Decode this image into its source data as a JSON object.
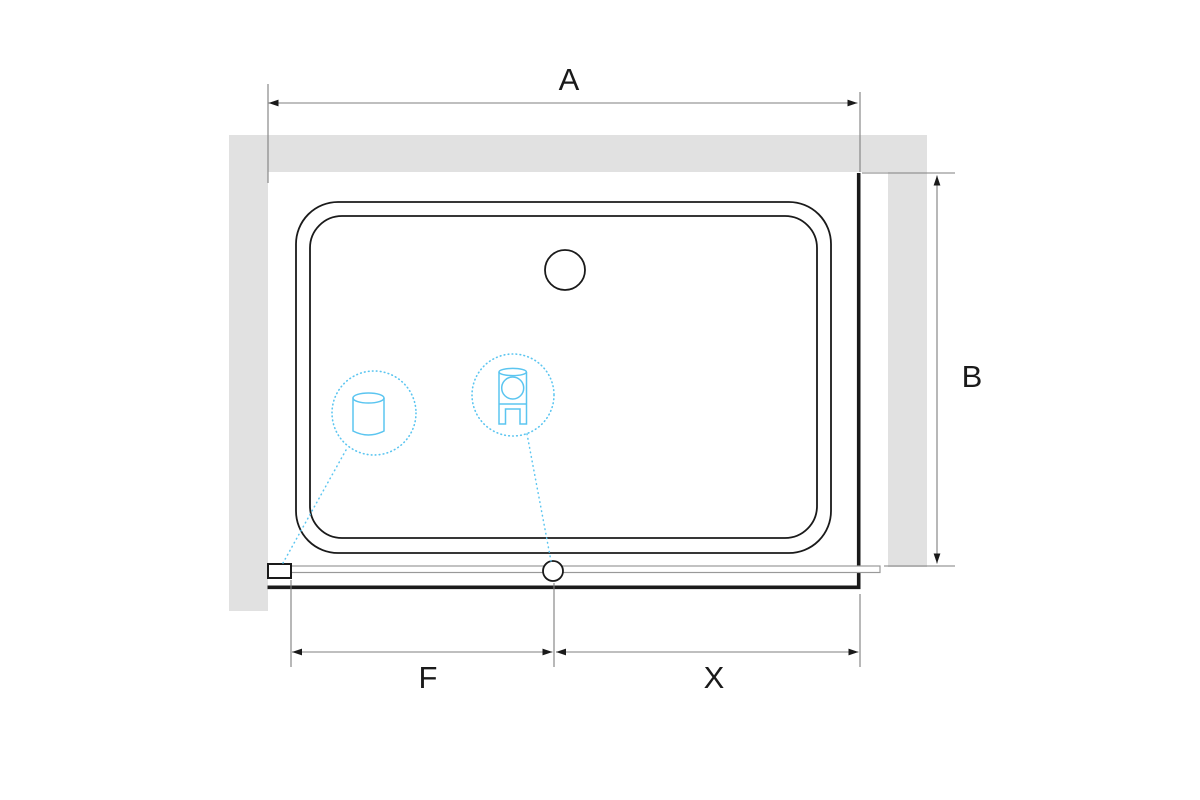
{
  "diagram": {
    "kind": "shower-enclosure-top-view-dimension-drawing",
    "dimension_labels": {
      "top": "A",
      "right": "B",
      "bottom_left": "F",
      "bottom_right": "X"
    },
    "colors": {
      "background": "#ffffff",
      "wall_fill": "#e1e1e1",
      "outline": "#1a1a1a",
      "dimension_line": "#7f7f7f",
      "accent": "#5bc5f0"
    },
    "callouts": [
      {
        "id": "handle-detail",
        "icon": "knob-cylinder-icon"
      },
      {
        "id": "roller-detail",
        "icon": "roller-bracket-icon"
      }
    ]
  }
}
